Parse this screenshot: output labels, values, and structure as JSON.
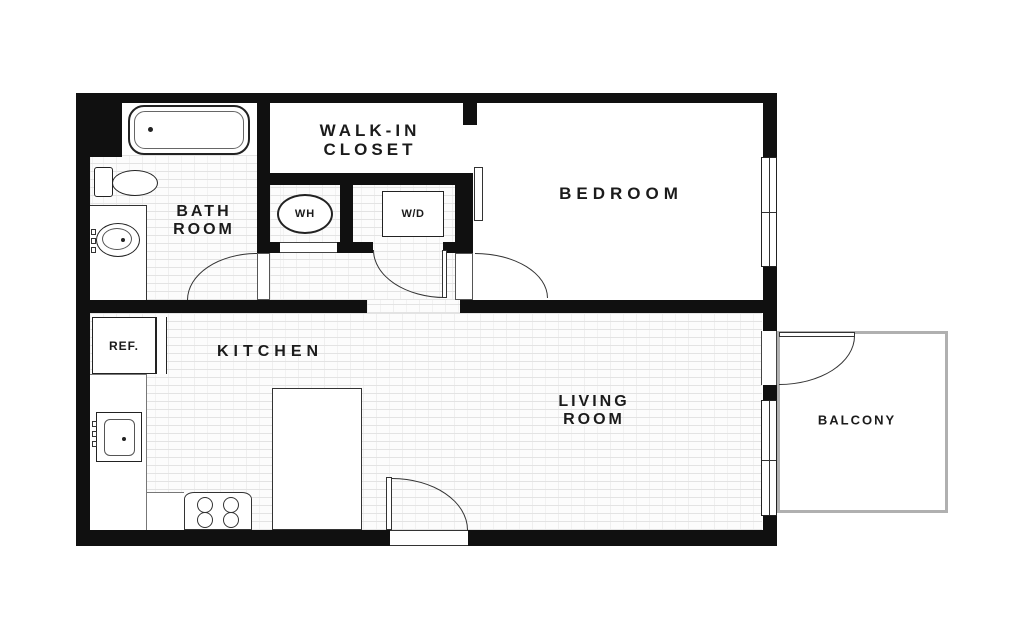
{
  "plan": {
    "title": "One-bedroom apartment floor plan"
  },
  "rooms": {
    "walk_in_closet": {
      "line1": "WALK-IN",
      "line2": "CLOSET"
    },
    "bedroom": {
      "label": "BEDROOM"
    },
    "bathroom": {
      "line1": "BATH",
      "line2": "ROOM"
    },
    "kitchen": {
      "label": "KITCHEN"
    },
    "living_room": {
      "line1": "LIVING",
      "line2": "ROOM"
    },
    "balcony": {
      "label": "BALCONY"
    }
  },
  "fixtures": {
    "water_heater": "WH",
    "washer_dryer": "W/D",
    "refrigerator": "REF."
  },
  "colors": {
    "wall": "#101010",
    "line": "#333333",
    "brick_line": "#e3e3e3",
    "balcony_border": "#b0b0b0",
    "text": "#1b1b1b"
  }
}
